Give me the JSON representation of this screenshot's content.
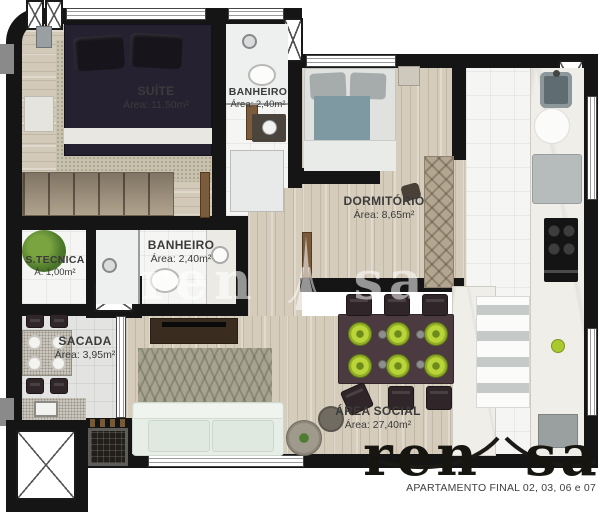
{
  "rooms": [
    {
      "name": "SUÍTE",
      "area": "Área: 11,50m²"
    },
    {
      "name": "BANHEIRO",
      "area": "Área: 2,40m²"
    },
    {
      "name": "DORMITÓRIO",
      "area": "Área: 8,65m²"
    },
    {
      "name": "BANHEIRO",
      "area": "Área: 2,40m²"
    },
    {
      "name": "S.TECNICA",
      "area": "Á: 1,00m²"
    },
    {
      "name": "SACADA",
      "area": "Área: 3,95m²"
    },
    {
      "name": "ÁREA SOCIAL",
      "area": "Área: 27,40m²"
    }
  ],
  "brand": {
    "left": "ren",
    "right": "sa"
  },
  "watermark": {
    "left": "ren",
    "right": "sa"
  },
  "footer": {
    "text": "APARTAMENTO FINAL 02, 03, 06 e 07"
  },
  "colors": {
    "wall": "#151515",
    "wood": "#d4cbba",
    "bath_tile": "#f5f6f4",
    "sacada_tile": "#e3e4e1",
    "accent_lime": "#a9c92e",
    "dining_table": "#4b3a40",
    "sofa": "#e7eee7",
    "logo": "#17150f"
  }
}
